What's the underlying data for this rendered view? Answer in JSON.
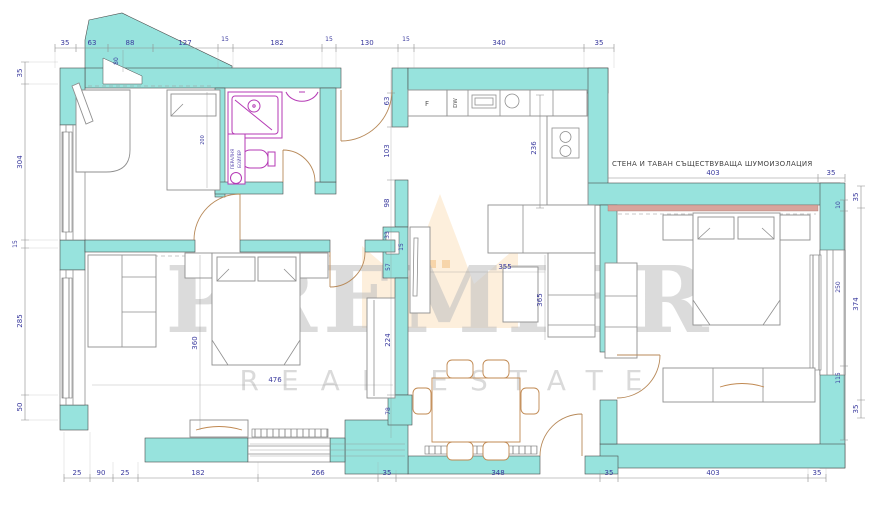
{
  "watermark": {
    "title": "PREMIER",
    "subtitle": "REAL ESTATE"
  },
  "note": {
    "text": "СТЕНА И ТАВАН СЪЩЕСТВУВАЩА ШУМОИЗОЛАЦИЯ"
  },
  "labels": {
    "fridge": "F",
    "dishwasher": "DW",
    "washing_machine": "ПЕРАЛНЯ",
    "boiler": "БОЙЛЕР"
  },
  "colors": {
    "wall": "#97e3dd",
    "fixture_accent": "#b53ab5",
    "dimension_text": "#3a3a9e",
    "insulation_strip": "#d8a49c",
    "watermark_crown": "#f2a93b",
    "chair_wood": "#c08850"
  },
  "dims": {
    "top": [
      "35",
      "63",
      "88",
      "127",
      "15",
      "182",
      "15",
      "130",
      "15",
      "340",
      "35"
    ],
    "top_left_vertical": "80",
    "left": [
      "35",
      "304",
      "15",
      "285",
      "50"
    ],
    "bottom": [
      "25",
      "90",
      "25",
      "182",
      "266",
      "35",
      "348",
      "35",
      "403",
      "35"
    ],
    "right_outer": [
      "35",
      "374",
      "35"
    ],
    "right_inner": [
      "10",
      "250",
      "115"
    ],
    "note_line": [
      "403",
      "35"
    ],
    "hall": [
      "63",
      "103",
      "98",
      "33",
      "15",
      "57",
      "224",
      "78"
    ],
    "kitchen": "236",
    "living": [
      "355",
      "365"
    ],
    "master": [
      "360",
      "476"
    ],
    "bed_room1": "200"
  }
}
